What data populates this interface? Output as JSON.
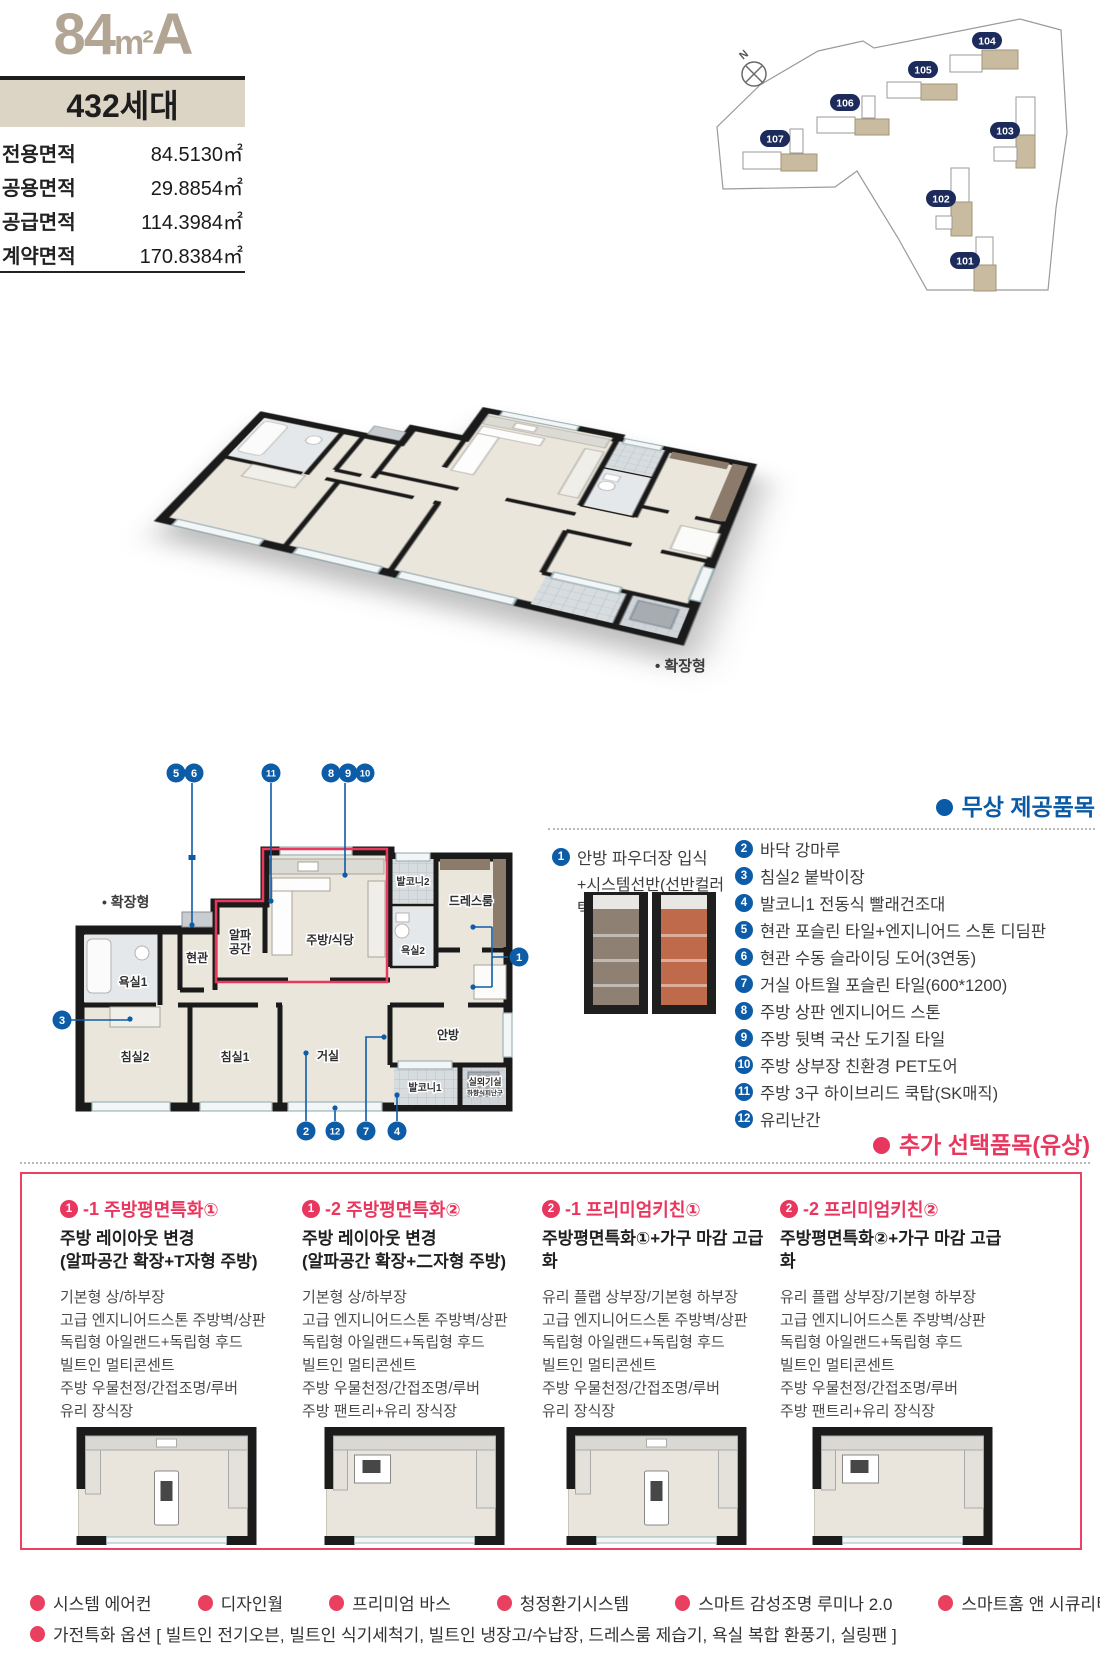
{
  "colors": {
    "accent_blue": "#0d5ca7",
    "accent_red": "#e9365e",
    "badge_navy": "#1c2b5c",
    "title_tan": "#b3a593",
    "box_beige": "#dcd4c4"
  },
  "header": {
    "unit_type_num": "84",
    "unit_type_sym": "m²",
    "unit_type_variant": "A",
    "household_count": "432세대",
    "area_rows": [
      {
        "label": "전용면적",
        "value": "84.5130㎡"
      },
      {
        "label": "공용면적",
        "value": "29.8854㎡"
      },
      {
        "label": "공급면적",
        "value": "114.3984㎡"
      },
      {
        "label": "계약면적",
        "value": "170.8384㎡"
      }
    ]
  },
  "site_map": {
    "north": "N",
    "buildings": [
      "104",
      "105",
      "106",
      "107",
      "103",
      "102",
      "101"
    ]
  },
  "iso_plan": {
    "caption": "• 확장형"
  },
  "floor_plan": {
    "caption": "• 확장형",
    "rooms": {
      "balcony2": "발코니2",
      "dressroom": "드레스룸",
      "entry": "현관",
      "alpha1": "알파",
      "alpha2": "공간",
      "kitchen": "주방/식당",
      "bath2": "욕실2",
      "bath1": "욕실1",
      "bedroom2": "침실2",
      "bedroom1": "침실1",
      "living": "거실",
      "master": "안방",
      "balcony1": "발코니1",
      "outdoor_unit": "실외기실",
      "outdoor_note": "하향식피난구"
    },
    "markers": {
      "n1": "1",
      "n2": "2",
      "n3": "3",
      "n4": "4",
      "n5": "5",
      "n6": "6",
      "n7": "7",
      "n8": "8",
      "n9": "9",
      "n10": "10",
      "n11": "11",
      "n12": "12"
    }
  },
  "free_section": {
    "title": "무상 제공품목",
    "items": [
      {
        "no": "1",
        "text": "안방 파우더장 입식",
        "text2": "+시스템선반(선반컬러 택1)"
      },
      {
        "no": "2",
        "text": "바닥 강마루"
      },
      {
        "no": "3",
        "text": "침실2 붙박이장"
      },
      {
        "no": "4",
        "text": "발코니1 전동식 빨래건조대"
      },
      {
        "no": "5",
        "text": "현관 포슬린 타일+엔지니어드 스톤 디딤판"
      },
      {
        "no": "6",
        "text": "현관 수동 슬라이딩 도어(3연동)"
      },
      {
        "no": "7",
        "text": "거실 아트월 포슬린 타일(600*1200)"
      },
      {
        "no": "8",
        "text": "주방 상판 엔지니어드 스톤"
      },
      {
        "no": "9",
        "text": "주방 뒷벽 국산 도기질 타일"
      },
      {
        "no": "10",
        "text": "주방 상부장 친환경 PET도어"
      },
      {
        "no": "11",
        "text": "주방 3구 하이브리드 쿡탑(SK매직)"
      },
      {
        "no": "12",
        "text": "유리난간"
      }
    ]
  },
  "paid_section": {
    "title": "추가 선택품목(유상)",
    "options": [
      {
        "num": "1",
        "suffix": "-1",
        "name": "주방평면특화①",
        "subtitle1": "주방 레이아웃 변경",
        "subtitle2": "(알파공간 확장+T자형 주방)",
        "features": [
          "기본형 상/하부장",
          "고급 엔지니어드스톤 주방벽/상판",
          "독립형 아일랜드+독립형 후드",
          "빌트인 멀티콘센트",
          "주방 우물천정/간접조명/루버",
          "유리 장식장"
        ]
      },
      {
        "num": "1",
        "suffix": "-2",
        "name": "주방평면특화②",
        "subtitle1": "주방 레이아웃 변경",
        "subtitle2": "(알파공간 확장+二자형 주방)",
        "features": [
          "기본형 상/하부장",
          "고급 엔지니어드스톤 주방벽/상판",
          "독립형 아일랜드+독립형 후드",
          "빌트인 멀티콘센트",
          "주방 우물천정/간접조명/루버",
          "주방 팬트리+유리 장식장"
        ]
      },
      {
        "num": "2",
        "suffix": "-1",
        "name": "프리미엄키친①",
        "subtitle1": "주방평면특화①+가구 마감 고급화",
        "subtitle2": "",
        "features": [
          "유리 플랩 상부장/기본형 하부장",
          "고급 엔지니어드스톤 주방벽/상판",
          "독립형 아일랜드+독립형 후드",
          "빌트인 멀티콘센트",
          "주방 우물천정/간접조명/루버",
          "유리 장식장"
        ]
      },
      {
        "num": "2",
        "suffix": "-2",
        "name": "프리미엄키친②",
        "subtitle1": "주방평면특화②+가구 마감 고급화",
        "subtitle2": "",
        "features": [
          "유리 플랩 상부장/기본형 하부장",
          "고급 엔지니어드스톤 주방벽/상판",
          "독립형 아일랜드+독립형 후드",
          "빌트인 멀티콘센트",
          "주방 우물천정/간접조명/루버",
          "주방 팬트리+유리 장식장"
        ]
      }
    ]
  },
  "footer": {
    "options": [
      "시스템 에어컨",
      "디자인월",
      "프리미엄 바스",
      "청정환기시스템",
      "스마트 감성조명 루미나 2.0",
      "스마트홈 앤 시큐리티"
    ],
    "appliance_line": "가전특화 옵션 [ 빌트인 전기오븐, 빌트인 식기세척기, 빌트인 냉장고/수납장, 드레스룸 제습기, 욕실 복합 환풍기, 실링팬 ]"
  }
}
